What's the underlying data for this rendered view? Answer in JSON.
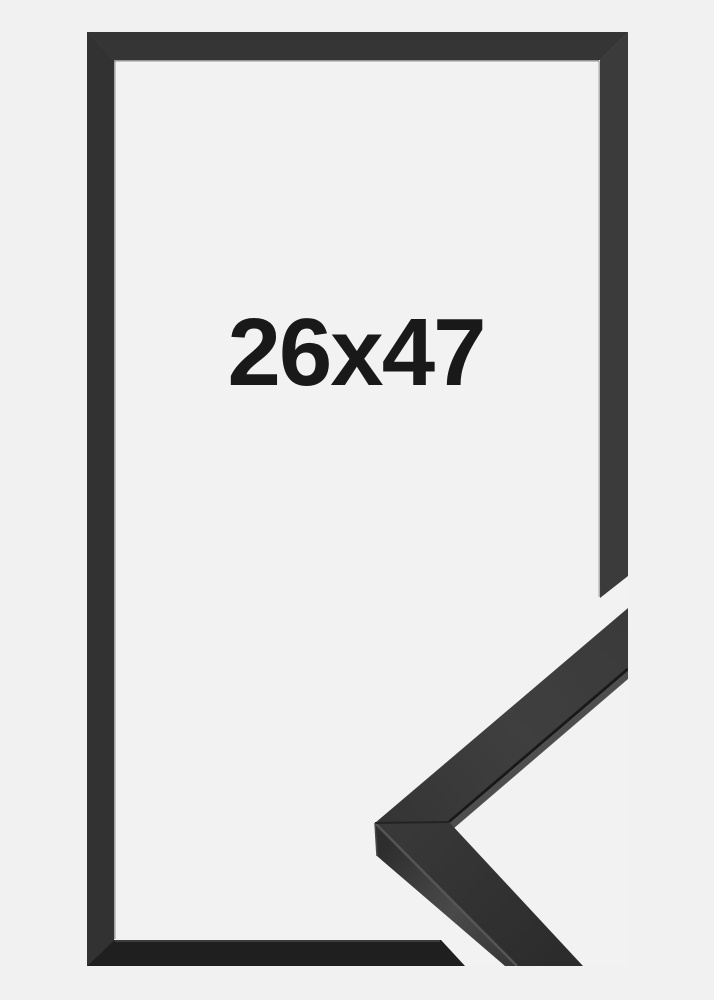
{
  "photo": {
    "size_label": "26x47"
  },
  "colors": {
    "background": "#f0f1f0",
    "frame_interior": "#f2f2f2",
    "frame_border_top": "#353535",
    "frame_border_right": "#3b3b3b",
    "frame_border_bottom": "#1f1f1f",
    "frame_border_left": "#323232",
    "sample_top_arm_face": "#3d3d3d",
    "sample_bottom_arm_face": "#323232",
    "sample_side_face": "#3a3a3a",
    "sample_edge_highlight": "#585858",
    "label_text": "#191919"
  }
}
